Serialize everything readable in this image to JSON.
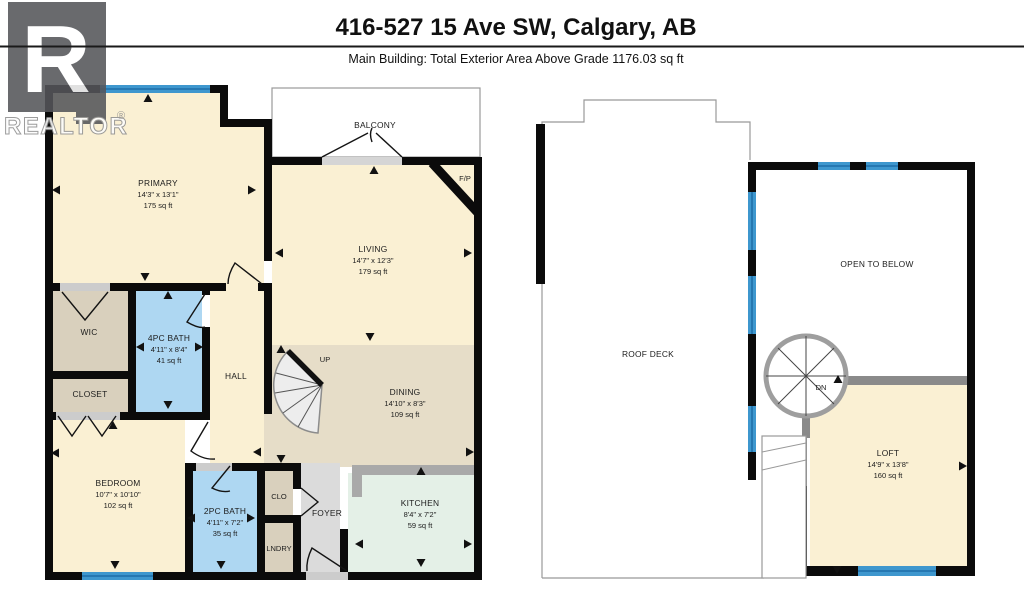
{
  "header": {
    "title": "416-527 15 Ave SW, Calgary, AB",
    "subtitle": "Main Building: Total Exterior Area Above Grade 1176.03 sq ft"
  },
  "watermark": {
    "letter": "R",
    "brand": "REALTOR",
    "registered": "®"
  },
  "floors": {
    "main": {
      "primary": {
        "name": "PRIMARY",
        "dims": "14'3\" x 13'1\"",
        "area": "175 sq ft"
      },
      "living": {
        "name": "LIVING",
        "dims": "14'7\" x 12'3\"",
        "area": "179 sq ft"
      },
      "dining": {
        "name": "DINING",
        "dims": "14'10\" x 8'3\"",
        "area": "109 sq ft"
      },
      "bath4": {
        "name": "4PC BATH",
        "dims": "4'11\" x 8'4\"",
        "area": "41 sq ft"
      },
      "bedroom": {
        "name": "BEDROOM",
        "dims": "10'7\" x 10'10\"",
        "area": "102 sq ft"
      },
      "bath2": {
        "name": "2PC BATH",
        "dims": "4'11\" x 7'2\"",
        "area": "35 sq ft"
      },
      "kitchen": {
        "name": "KITCHEN",
        "dims": "8'4\" x 7'2\"",
        "area": "59 sq ft"
      },
      "wic": {
        "name": "WIC"
      },
      "closet": {
        "name": "CLOSET"
      },
      "hall": {
        "name": "HALL"
      },
      "balcony": {
        "name": "BALCONY"
      },
      "fireplace": {
        "name": "F/P"
      },
      "clo": {
        "name": "CLO"
      },
      "foyer": {
        "name": "FOYER"
      },
      "lndry": {
        "name": "LNDRY"
      },
      "stairs_up": {
        "name": "UP"
      }
    },
    "upper": {
      "roof_deck": {
        "name": "ROOF DECK"
      },
      "open_to_below": {
        "name": "OPEN TO BELOW"
      },
      "loft": {
        "name": "LOFT",
        "dims": "14'9\" x 13'8\"",
        "area": "160 sq ft"
      },
      "stairs_down": {
        "name": "DN"
      }
    }
  },
  "colors": {
    "wall": "#0b0b0b",
    "room_cream": "#FAF0D3",
    "room_tan": "#E6DDC8",
    "room_taupe": "#D9D0BD",
    "room_bath_blue": "#AED7F2",
    "room_mint": "#E4F0E7",
    "room_foyer_gray": "#DBDBDB",
    "window_blue": "#3E97CE",
    "window_stripe": "#1F6FA8",
    "counter_gray": "#A9A9A9",
    "outline_gray": "#999999",
    "sill_gray": "#CCCCCC",
    "gray_wall": "#8A8A8A"
  },
  "arrows": [
    {
      "x": 148,
      "y": 99,
      "d": "up"
    },
    {
      "x": 57,
      "y": 190,
      "d": "left"
    },
    {
      "x": 251,
      "y": 190,
      "d": "right"
    },
    {
      "x": 145,
      "y": 276,
      "d": "down"
    },
    {
      "x": 374,
      "y": 171,
      "d": "up"
    },
    {
      "x": 280,
      "y": 253,
      "d": "left"
    },
    {
      "x": 467,
      "y": 253,
      "d": "right"
    },
    {
      "x": 370,
      "y": 336,
      "d": "down"
    },
    {
      "x": 281,
      "y": 350,
      "d": "up"
    },
    {
      "x": 258,
      "y": 452,
      "d": "left"
    },
    {
      "x": 469,
      "y": 452,
      "d": "right"
    },
    {
      "x": 281,
      "y": 458,
      "d": "down"
    },
    {
      "x": 168,
      "y": 296,
      "d": "up"
    },
    {
      "x": 141,
      "y": 347,
      "d": "left"
    },
    {
      "x": 198,
      "y": 347,
      "d": "right"
    },
    {
      "x": 168,
      "y": 404,
      "d": "down"
    },
    {
      "x": 56,
      "y": 453,
      "d": "left"
    },
    {
      "x": 113,
      "y": 426,
      "d": "up"
    },
    {
      "x": 115,
      "y": 564,
      "d": "down"
    },
    {
      "x": 192,
      "y": 518,
      "d": "left"
    },
    {
      "x": 250,
      "y": 518,
      "d": "right"
    },
    {
      "x": 221,
      "y": 564,
      "d": "down"
    },
    {
      "x": 421,
      "y": 472,
      "d": "up"
    },
    {
      "x": 360,
      "y": 544,
      "d": "left"
    },
    {
      "x": 467,
      "y": 544,
      "d": "right"
    },
    {
      "x": 421,
      "y": 562,
      "d": "down"
    },
    {
      "x": 838,
      "y": 380,
      "d": "up"
    },
    {
      "x": 962,
      "y": 466,
      "d": "right"
    },
    {
      "x": 837,
      "y": 569,
      "d": "down"
    }
  ]
}
